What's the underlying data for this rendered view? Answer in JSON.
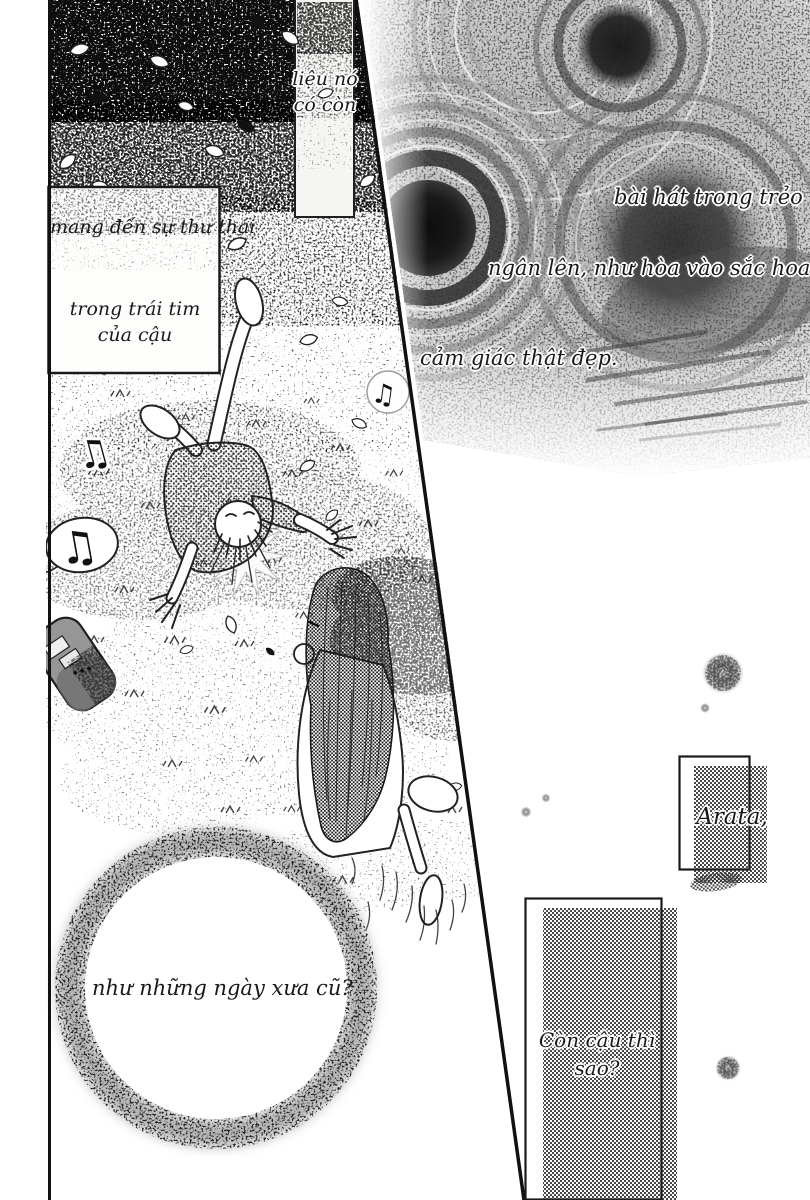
{
  "page": {
    "kind": "manga page (Vietnamese translation)",
    "width": 810,
    "height": 1200
  },
  "palette": {
    "paper": "#ffffff",
    "ink": "#1a1a1a",
    "halftone_dot": "#2a2a2a",
    "speckle_gray": "#9a9a9a"
  },
  "texts": {
    "strip": {
      "line1": "liệu nó",
      "line2": "có còn"
    },
    "caption_box": {
      "line1": "mang đến sự thư thái",
      "line2": "trong trái tim",
      "line3": "của cậu"
    },
    "lyric1": "bài hát trong trẻo",
    "lyric2": "ngân lên, như hòa vào sắc hoa cỏ.",
    "lyric3": "cảm giác thật đẹp.",
    "name_panel": "Arata,",
    "circle_caption": "như những ngày xưa cũ?",
    "question_panel": {
      "line1": "Còn cậu thì",
      "line2": "sao?"
    }
  },
  "glyphs": {
    "double_note": "♫",
    "single_note": "♪"
  }
}
